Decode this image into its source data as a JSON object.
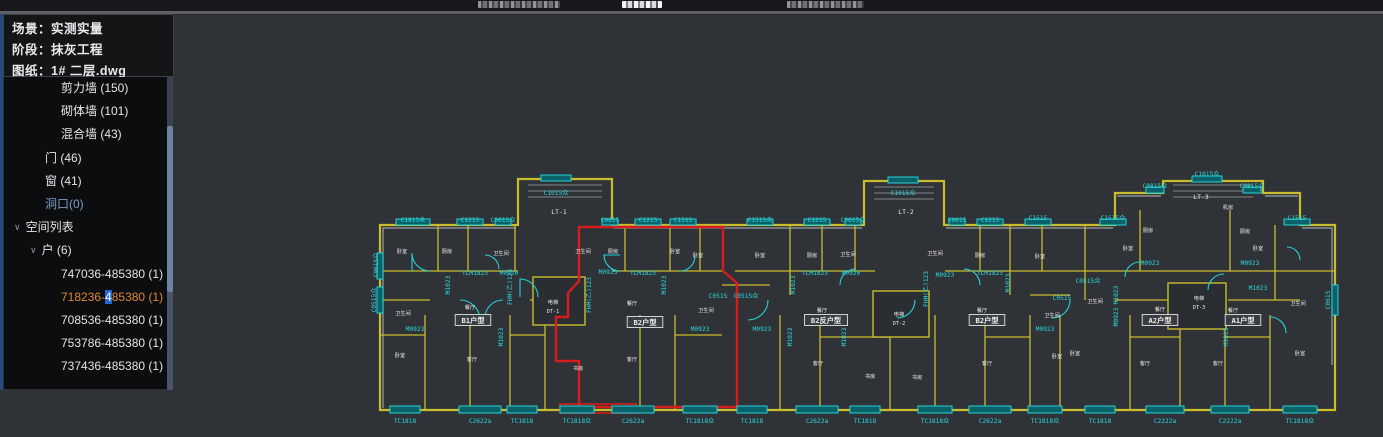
{
  "top_bar": {
    "fragments": [
      {
        "x": 478,
        "w": 82,
        "bright": false
      },
      {
        "x": 622,
        "w": 40,
        "bright": true
      },
      {
        "x": 787,
        "w": 77,
        "bright": false
      }
    ]
  },
  "panel": {
    "header_lines": [
      {
        "key": "场景：",
        "value": "实测实量"
      },
      {
        "key": "阶段：",
        "value": "抹灰工程"
      },
      {
        "key": "图纸：",
        "value": "1# 二层.dwg"
      }
    ],
    "tree_items": [
      {
        "label": "剪力墙 (150)",
        "indent": 57
      },
      {
        "label": "砌体墙 (101)",
        "indent": 57
      },
      {
        "label": "混合墙 (43)",
        "indent": 57
      },
      {
        "label": "门 (46)",
        "indent": 41
      },
      {
        "label": "窗 (41)",
        "indent": 41
      },
      {
        "label": "洞口(0)",
        "indent": 41,
        "color": "#7e9fc8"
      },
      {
        "label": "空间列表",
        "indent": 10,
        "chevron": true
      },
      {
        "label": "户 (6)",
        "indent": 26,
        "chevron": true
      },
      {
        "label": "747036-485380 (1)",
        "indent": 57
      },
      {
        "label": "718236-485380 (1)",
        "indent": 57,
        "selected": true,
        "parts": {
          "prefix": "718236-",
          "highlight": "4",
          "suffix": "85380 (1)"
        }
      },
      {
        "label": "708536-485380 (1)",
        "indent": 57
      },
      {
        "label": "753786-485380 (1)",
        "indent": 57
      },
      {
        "label": "737436-485380 (1)",
        "indent": 57
      }
    ],
    "colors": {
      "selected": "#e08a2d",
      "highlight_bg": "#2566d2"
    }
  },
  "drawing": {
    "colors": {
      "wall_yellow": "#c9bd2e",
      "wall_gray": "#99a1a7",
      "window_cyan": "#23d3da",
      "selection_red": "#d61c1c",
      "text_cyan": "#2adbe2",
      "text_white": "#e8ebee"
    },
    "stair_labels": [
      {
        "t": "LT-1",
        "x": 189,
        "y": 49
      },
      {
        "t": "LT-2",
        "x": 536,
        "y": 49
      },
      {
        "t": "LT-3",
        "x": 831,
        "y": 34
      }
    ],
    "elevator_labels": [
      {
        "t": "电梯",
        "x": 183,
        "y": 139
      },
      {
        "t": "DT-1",
        "x": 183,
        "y": 148
      },
      {
        "t": "电梯",
        "x": 529,
        "y": 151
      },
      {
        "t": "DT-2",
        "x": 529,
        "y": 160
      },
      {
        "t": "电梯",
        "x": 829,
        "y": 135
      },
      {
        "t": "DT-3",
        "x": 829,
        "y": 144
      }
    ],
    "unit_labels": [
      {
        "t": "B1户型",
        "x": 103,
        "y": 158
      },
      {
        "t": "B2户型",
        "x": 275,
        "y": 160
      },
      {
        "t": "B2反户型",
        "x": 456,
        "y": 158
      },
      {
        "t": "B2户型",
        "x": 617,
        "y": 158
      },
      {
        "t": "A2户型",
        "x": 790,
        "y": 158
      },
      {
        "t": "A1户型",
        "x": 873,
        "y": 158
      }
    ],
    "top_codes": [
      {
        "t": "C1815众",
        "x": 43,
        "y": 57,
        "w": 34,
        "wy": 57
      },
      {
        "t": "C1215",
        "x": 100,
        "y": 57,
        "w": 26,
        "wy": 57
      },
      {
        "t": "C0615众",
        "x": 133,
        "y": 57,
        "w": 16,
        "wy": 57
      },
      {
        "t": "C1015众",
        "x": 186,
        "y": 30,
        "w": 30,
        "wy": 13
      },
      {
        "t": "C0615",
        "x": 240,
        "y": 57,
        "w": 16,
        "wy": 57
      },
      {
        "t": "C1215",
        "x": 278,
        "y": 57,
        "w": 26,
        "wy": 57
      },
      {
        "t": "C1515",
        "x": 313,
        "y": 57,
        "w": 26,
        "wy": 57
      },
      {
        "t": "C1515众",
        "x": 390,
        "y": 57,
        "w": 26,
        "wy": 57
      },
      {
        "t": "C1215",
        "x": 447,
        "y": 57,
        "w": 26,
        "wy": 57
      },
      {
        "t": "C0615众",
        "x": 483,
        "y": 57,
        "w": 16,
        "wy": 57
      },
      {
        "t": "C1015众",
        "x": 533,
        "y": 30,
        "w": 30,
        "wy": 15
      },
      {
        "t": "C0615",
        "x": 587,
        "y": 57,
        "w": 16,
        "wy": 57
      },
      {
        "t": "C1215",
        "x": 620,
        "y": 57,
        "w": 26,
        "wy": 57
      },
      {
        "t": "C1515",
        "x": 668,
        "y": 55,
        "w": 26,
        "wy": 57
      },
      {
        "t": "C1515众",
        "x": 743,
        "y": 55,
        "w": 26,
        "wy": 57
      },
      {
        "t": "C0815众",
        "x": 785,
        "y": 23,
        "w": 18,
        "wy": 25
      },
      {
        "t": "C1015众",
        "x": 837,
        "y": 11,
        "w": 30,
        "wy": 14
      },
      {
        "t": "C0815众",
        "x": 882,
        "y": 23,
        "w": 18,
        "wy": 25
      },
      {
        "t": "C1515",
        "x": 927,
        "y": 55,
        "w": 26,
        "wy": 57
      }
    ],
    "bottom_codes": [
      {
        "t": "TC1818",
        "x": 35,
        "w": 30
      },
      {
        "t": "C2622a",
        "x": 110,
        "w": 42
      },
      {
        "t": "TC1818",
        "x": 152,
        "w": 30
      },
      {
        "t": "TC1818众",
        "x": 207,
        "w": 34,
        "red": true
      },
      {
        "t": "C2622a",
        "x": 263,
        "w": 42
      },
      {
        "t": "TC1818众",
        "x": 330,
        "w": 34
      },
      {
        "t": "TC1818",
        "x": 382,
        "w": 30
      },
      {
        "t": "C2622a",
        "x": 447,
        "w": 42
      },
      {
        "t": "TC1818",
        "x": 495,
        "w": 30
      },
      {
        "t": "TC1818众",
        "x": 565,
        "w": 34
      },
      {
        "t": "C2622a",
        "x": 620,
        "w": 42
      },
      {
        "t": "TC1818众",
        "x": 675,
        "w": 34
      },
      {
        "t": "TC1818",
        "x": 730,
        "w": 30
      },
      {
        "t": "C2222a",
        "x": 795,
        "w": 38
      },
      {
        "t": "C2222a",
        "x": 860,
        "w": 38
      },
      {
        "t": "TC1818众",
        "x": 930,
        "w": 34
      }
    ],
    "mid_codes": [
      {
        "t": "TLM1823",
        "x": 105,
        "y": 110
      },
      {
        "t": "M0920",
        "x": 139,
        "y": 110
      },
      {
        "t": "M0923",
        "x": 45,
        "y": 166
      },
      {
        "t": "M0923",
        "x": 238,
        "y": 109
      },
      {
        "t": "TLM1823",
        "x": 273,
        "y": 110
      },
      {
        "t": "M0923",
        "x": 330,
        "y": 166
      },
      {
        "t": "M0923",
        "x": 392,
        "y": 166
      },
      {
        "t": "TLM1823",
        "x": 445,
        "y": 110
      },
      {
        "t": "M0920",
        "x": 481,
        "y": 110
      },
      {
        "t": "M0923",
        "x": 575,
        "y": 112
      },
      {
        "t": "TLM1823",
        "x": 620,
        "y": 110
      },
      {
        "t": "M0923",
        "x": 675,
        "y": 166
      },
      {
        "t": "M0923",
        "x": 780,
        "y": 100
      },
      {
        "t": "M0923",
        "x": 880,
        "y": 100
      },
      {
        "t": "C0515",
        "x": 348,
        "y": 133
      },
      {
        "t": "C0515众",
        "x": 376,
        "y": 133
      },
      {
        "t": "C0515",
        "x": 692,
        "y": 135
      },
      {
        "t": "C0515众",
        "x": 718,
        "y": 118
      },
      {
        "t": "M1023",
        "x": 888,
        "y": 125
      }
    ],
    "vert_codes": [
      {
        "t": "M1023",
        "x": 80,
        "y": 120
      },
      {
        "t": "M1023",
        "x": 133,
        "y": 172
      },
      {
        "t": "M1023",
        "x": 296,
        "y": 120
      },
      {
        "t": "M1023",
        "x": 425,
        "y": 120
      },
      {
        "t": "M1023",
        "x": 422,
        "y": 172
      },
      {
        "t": "M1023",
        "x": 476,
        "y": 172
      },
      {
        "t": "M1023",
        "x": 640,
        "y": 118
      },
      {
        "t": "M1023",
        "x": 748,
        "y": 130
      },
      {
        "t": "M0923",
        "x": 748,
        "y": 152
      },
      {
        "t": "M1023",
        "x": 858,
        "y": 172
      },
      {
        "t": "FHM(乙)123",
        "x": 142,
        "y": 122
      },
      {
        "t": "FHM(乙)123",
        "x": 221,
        "y": 130
      },
      {
        "t": "FHM(乙)123",
        "x": 558,
        "y": 124
      },
      {
        "t": "C0515众",
        "x": 6,
        "y": 135
      },
      {
        "t": "C0615众",
        "x": 8,
        "y": 100
      },
      {
        "t": "C0615",
        "x": 960,
        "y": 135
      }
    ],
    "room_labels": [
      {
        "t": "卧室",
        "x": 32,
        "y": 88
      },
      {
        "t": "厨房",
        "x": 77,
        "y": 88
      },
      {
        "t": "卫生间",
        "x": 131,
        "y": 90
      },
      {
        "t": "卫生间",
        "x": 33,
        "y": 150
      },
      {
        "t": "餐厅",
        "x": 100,
        "y": 144
      },
      {
        "t": "客厅",
        "x": 102,
        "y": 196
      },
      {
        "t": "卧室",
        "x": 30,
        "y": 192
      },
      {
        "t": "卫生间",
        "x": 213,
        "y": 88
      },
      {
        "t": "厨房",
        "x": 243,
        "y": 88
      },
      {
        "t": "卧室",
        "x": 305,
        "y": 88
      },
      {
        "t": "餐厅",
        "x": 262,
        "y": 140
      },
      {
        "t": "客厅",
        "x": 262,
        "y": 196
      },
      {
        "t": "书房",
        "x": 208,
        "y": 205
      },
      {
        "t": "卫生间",
        "x": 336,
        "y": 147
      },
      {
        "t": "卧室",
        "x": 328,
        "y": 92
      },
      {
        "t": "卧室",
        "x": 390,
        "y": 92
      },
      {
        "t": "厨房",
        "x": 442,
        "y": 92
      },
      {
        "t": "卫生间",
        "x": 478,
        "y": 91
      },
      {
        "t": "餐厅",
        "x": 452,
        "y": 147
      },
      {
        "t": "客厅",
        "x": 448,
        "y": 200
      },
      {
        "t": "书房",
        "x": 500,
        "y": 213
      },
      {
        "t": "书房",
        "x": 547,
        "y": 214
      },
      {
        "t": "卫生间",
        "x": 565,
        "y": 90
      },
      {
        "t": "厨房",
        "x": 610,
        "y": 92
      },
      {
        "t": "卧室",
        "x": 670,
        "y": 93
      },
      {
        "t": "餐厅",
        "x": 612,
        "y": 147
      },
      {
        "t": "客厅",
        "x": 617,
        "y": 200
      },
      {
        "t": "卧室",
        "x": 687,
        "y": 193
      },
      {
        "t": "卫生间",
        "x": 682,
        "y": 152
      },
      {
        "t": "卫生间",
        "x": 725,
        "y": 138
      },
      {
        "t": "厨房",
        "x": 778,
        "y": 67
      },
      {
        "t": "厨房",
        "x": 875,
        "y": 68
      },
      {
        "t": "机房",
        "x": 858,
        "y": 44
      },
      {
        "t": "卧室",
        "x": 758,
        "y": 85
      },
      {
        "t": "卧室",
        "x": 888,
        "y": 85
      },
      {
        "t": "餐厅",
        "x": 790,
        "y": 146
      },
      {
        "t": "餐厅",
        "x": 863,
        "y": 147
      },
      {
        "t": "客厅",
        "x": 775,
        "y": 200
      },
      {
        "t": "客厅",
        "x": 848,
        "y": 200
      },
      {
        "t": "卧室",
        "x": 705,
        "y": 190
      },
      {
        "t": "卧室",
        "x": 930,
        "y": 190
      },
      {
        "t": "卫生间",
        "x": 928,
        "y": 140
      }
    ]
  }
}
